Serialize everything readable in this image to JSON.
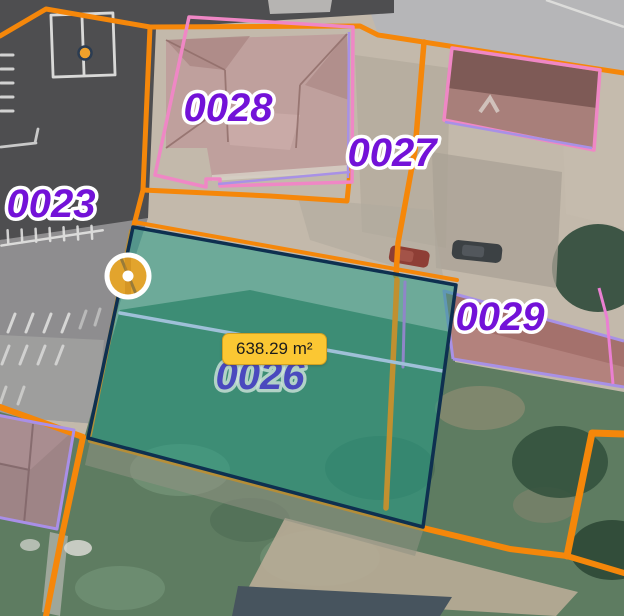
{
  "app": {
    "name": "cadastral-map-viewer",
    "basemap": "satellite-orthophoto"
  },
  "measurement": {
    "area_label": "638.29 m²",
    "area_value": "638.29",
    "area_unit": "m²"
  },
  "parcels": [
    {
      "label": "0023"
    },
    {
      "label": "0028"
    },
    {
      "label": "0027"
    },
    {
      "label": "0029"
    },
    {
      "label": "0026"
    }
  ],
  "markers": [
    {
      "name": "measurement-vertex-marker"
    },
    {
      "name": "map-point-marker"
    }
  ],
  "colors": {
    "parcel_boundary_orange": "#f5870a",
    "building_outline_pink": "#ef87c5",
    "building_outline_lavender": "#a891e6",
    "building_outline_magenta": "#ea7fd2",
    "parcel_label_purple": "#7312d8",
    "measure_fill_teal": "rgba(30,158,136,0.52)",
    "measure_border_navy": "#0e3050",
    "marker_amber": "#e2a42d",
    "tooltip_yellow": "#fbc733",
    "highlight_line_blue": "#9fc0d8"
  }
}
